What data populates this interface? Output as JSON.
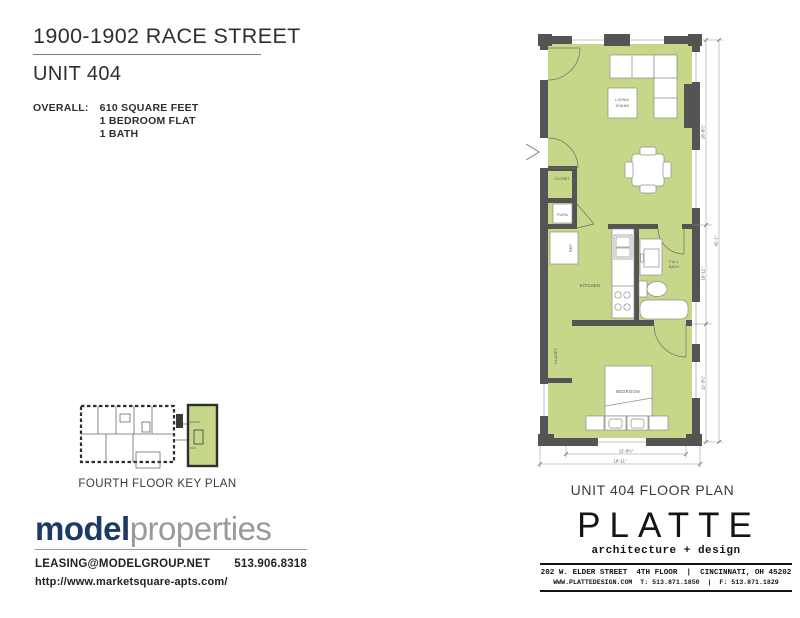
{
  "document": {
    "title": "1900-1902 RACE STREET",
    "unit": "UNIT 404"
  },
  "overall": {
    "label": "OVERALL:",
    "lines": [
      "610 SQUARE FEET",
      "1 BEDROOM FLAT",
      "1 BATH"
    ]
  },
  "floor_plan": {
    "caption": "UNIT 404 FLOOR PLAN",
    "labels": {
      "living_line1": "LIVING/",
      "living_line2": "DINING",
      "closet_upper": "CLOSET",
      "furnace": "FURN",
      "refrigerator": "REF",
      "kitchen": "KITCHEN",
      "bath_line1": "FULL",
      "bath_line2": "BATH",
      "closet_lower": "CLOSET",
      "bedroom": "BEDROOM"
    },
    "dimensions": {
      "right_top": "18'-8½\"",
      "right_middle": "10'-11\"",
      "right_bottom": "11'-3½\"",
      "right_overall": "42'-1\"",
      "bottom_inner": "12'-8½\"",
      "bottom_overall": "18'-11\""
    }
  },
  "key_plan": {
    "caption": "FOURTH FLOOR KEY PLAN"
  },
  "footer": {
    "model_properties": {
      "brand_primary": "model",
      "brand_secondary": "properties",
      "email": "LEASING@MODELGROUP.NET",
      "phone": "513.906.8318",
      "website": "http://www.marketsquare-apts.com/"
    },
    "platte": {
      "name": "PLATTE",
      "tagline": "architecture + design",
      "address": "202 W. ELDER STREET  4TH FLOOR  |  CINCINNATI, OH 45202",
      "contact": "WWW.PLATTEDESIGN.COM  T: 513.871.1850  |  F: 513.871.1829"
    }
  },
  "colors": {
    "floor_green": "#c6d78a",
    "wall_gray": "#545454",
    "brand_navy": "#1d3a66",
    "brand_gray": "#9a9a9a"
  }
}
